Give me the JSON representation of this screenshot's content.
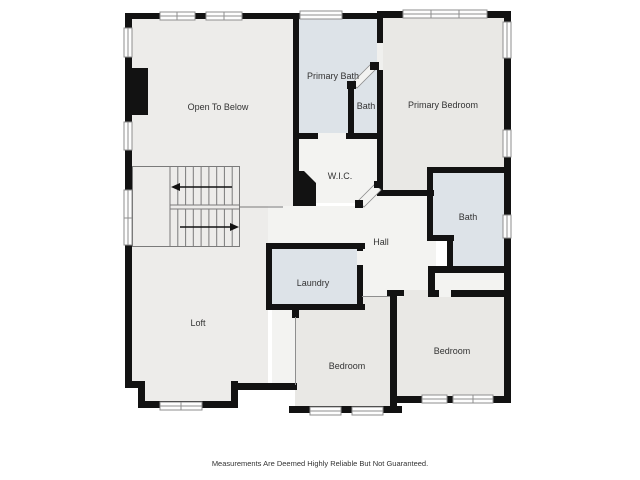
{
  "plan": {
    "rooms": {
      "open_to_below": "Open To Below",
      "primary_bath": "Primary Bath",
      "bath_small": "Bath",
      "primary_bedroom": "Primary Bedroom",
      "wic": "W.I.C.",
      "bath_right": "Bath",
      "hall": "Hall",
      "laundry": "Laundry",
      "loft": "Loft",
      "bedroom_left": "Bedroom",
      "bedroom_right": "Bedroom"
    },
    "disclaimer": "Measurements Are Deemed Highly Reliable But Not Guaranteed."
  },
  "colors": {
    "canvas": "#FFFFFF",
    "wall": "#121212",
    "room_gray": "#E9E8E5",
    "room_gray_light": "#EDECEA",
    "room_blue": "#DDE3E8",
    "room_light": "#F3F3F1",
    "window_fill": "#FDFDFD",
    "window_line": "#8E8E8E",
    "stair_line": "#7A7A7A",
    "label_text": "#333333"
  }
}
